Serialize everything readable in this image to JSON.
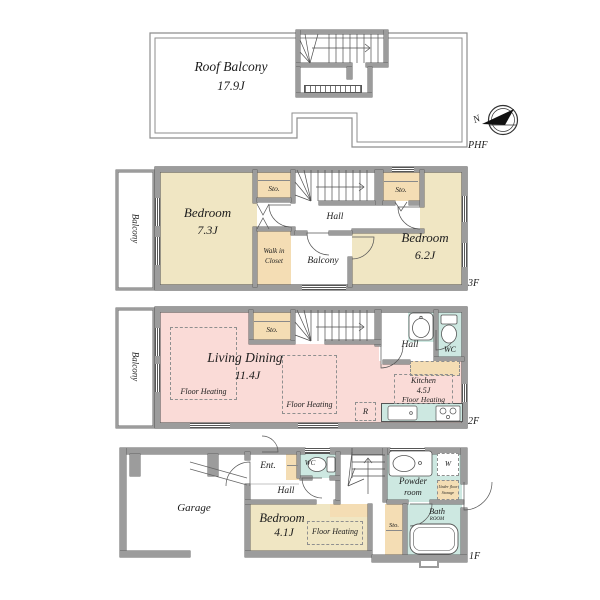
{
  "colors": {
    "wall": "#9c9c9c",
    "bedroom_fill": "#f0e6c3",
    "living_fill": "#fadbd7",
    "wet_fill": "#cde8e1",
    "closet_fill": "#f4ddb4"
  },
  "phf": {
    "floor_label": "PHF",
    "roof_balcony": {
      "name": "Roof Balcony",
      "area": "17.9J"
    },
    "compass_north": "N"
  },
  "f3": {
    "floor_label": "3F",
    "balcony_left": "Balcony",
    "bedroom_left": {
      "name": "Bedroom",
      "area": "7.3J"
    },
    "sto_left": "Sto.",
    "walk_in_closet": {
      "line1": "Walk in",
      "line2": "Closet"
    },
    "hall": "Hall",
    "sto_right": "Sto.",
    "bedroom_right": {
      "name": "Bedroom",
      "area": "6.2J"
    },
    "balcony_center": "Balcony"
  },
  "f2": {
    "floor_label": "2F",
    "balcony_left": "Balcony",
    "living_dining": {
      "name": "Living Dining",
      "area": "11.4J"
    },
    "floor_heating_left": "Floor Heating",
    "floor_heating_center": "Floor Heating",
    "sto": "Sto.",
    "hall": "Hall",
    "wc": "WC",
    "kitchen": {
      "name": "Kitchen",
      "area": "4.5J",
      "floor_heating": "Floor Heating"
    },
    "refrigerator": "R"
  },
  "f1": {
    "floor_label": "1F",
    "garage": "Garage",
    "entrance": "Ent.",
    "hall": "Hall",
    "wc": "WC",
    "bedroom": {
      "name": "Bedroom",
      "area": "4.1J"
    },
    "floor_heating": "Floor Heating",
    "powder_room": {
      "line1": "Powder",
      "line2": "room"
    },
    "washer": "W",
    "under_floor_storage": {
      "line1": "Under floor",
      "line2": "Storage"
    },
    "sto": "Sto.",
    "bath_room": {
      "line1": "Bath",
      "line2": "ROOM"
    }
  }
}
